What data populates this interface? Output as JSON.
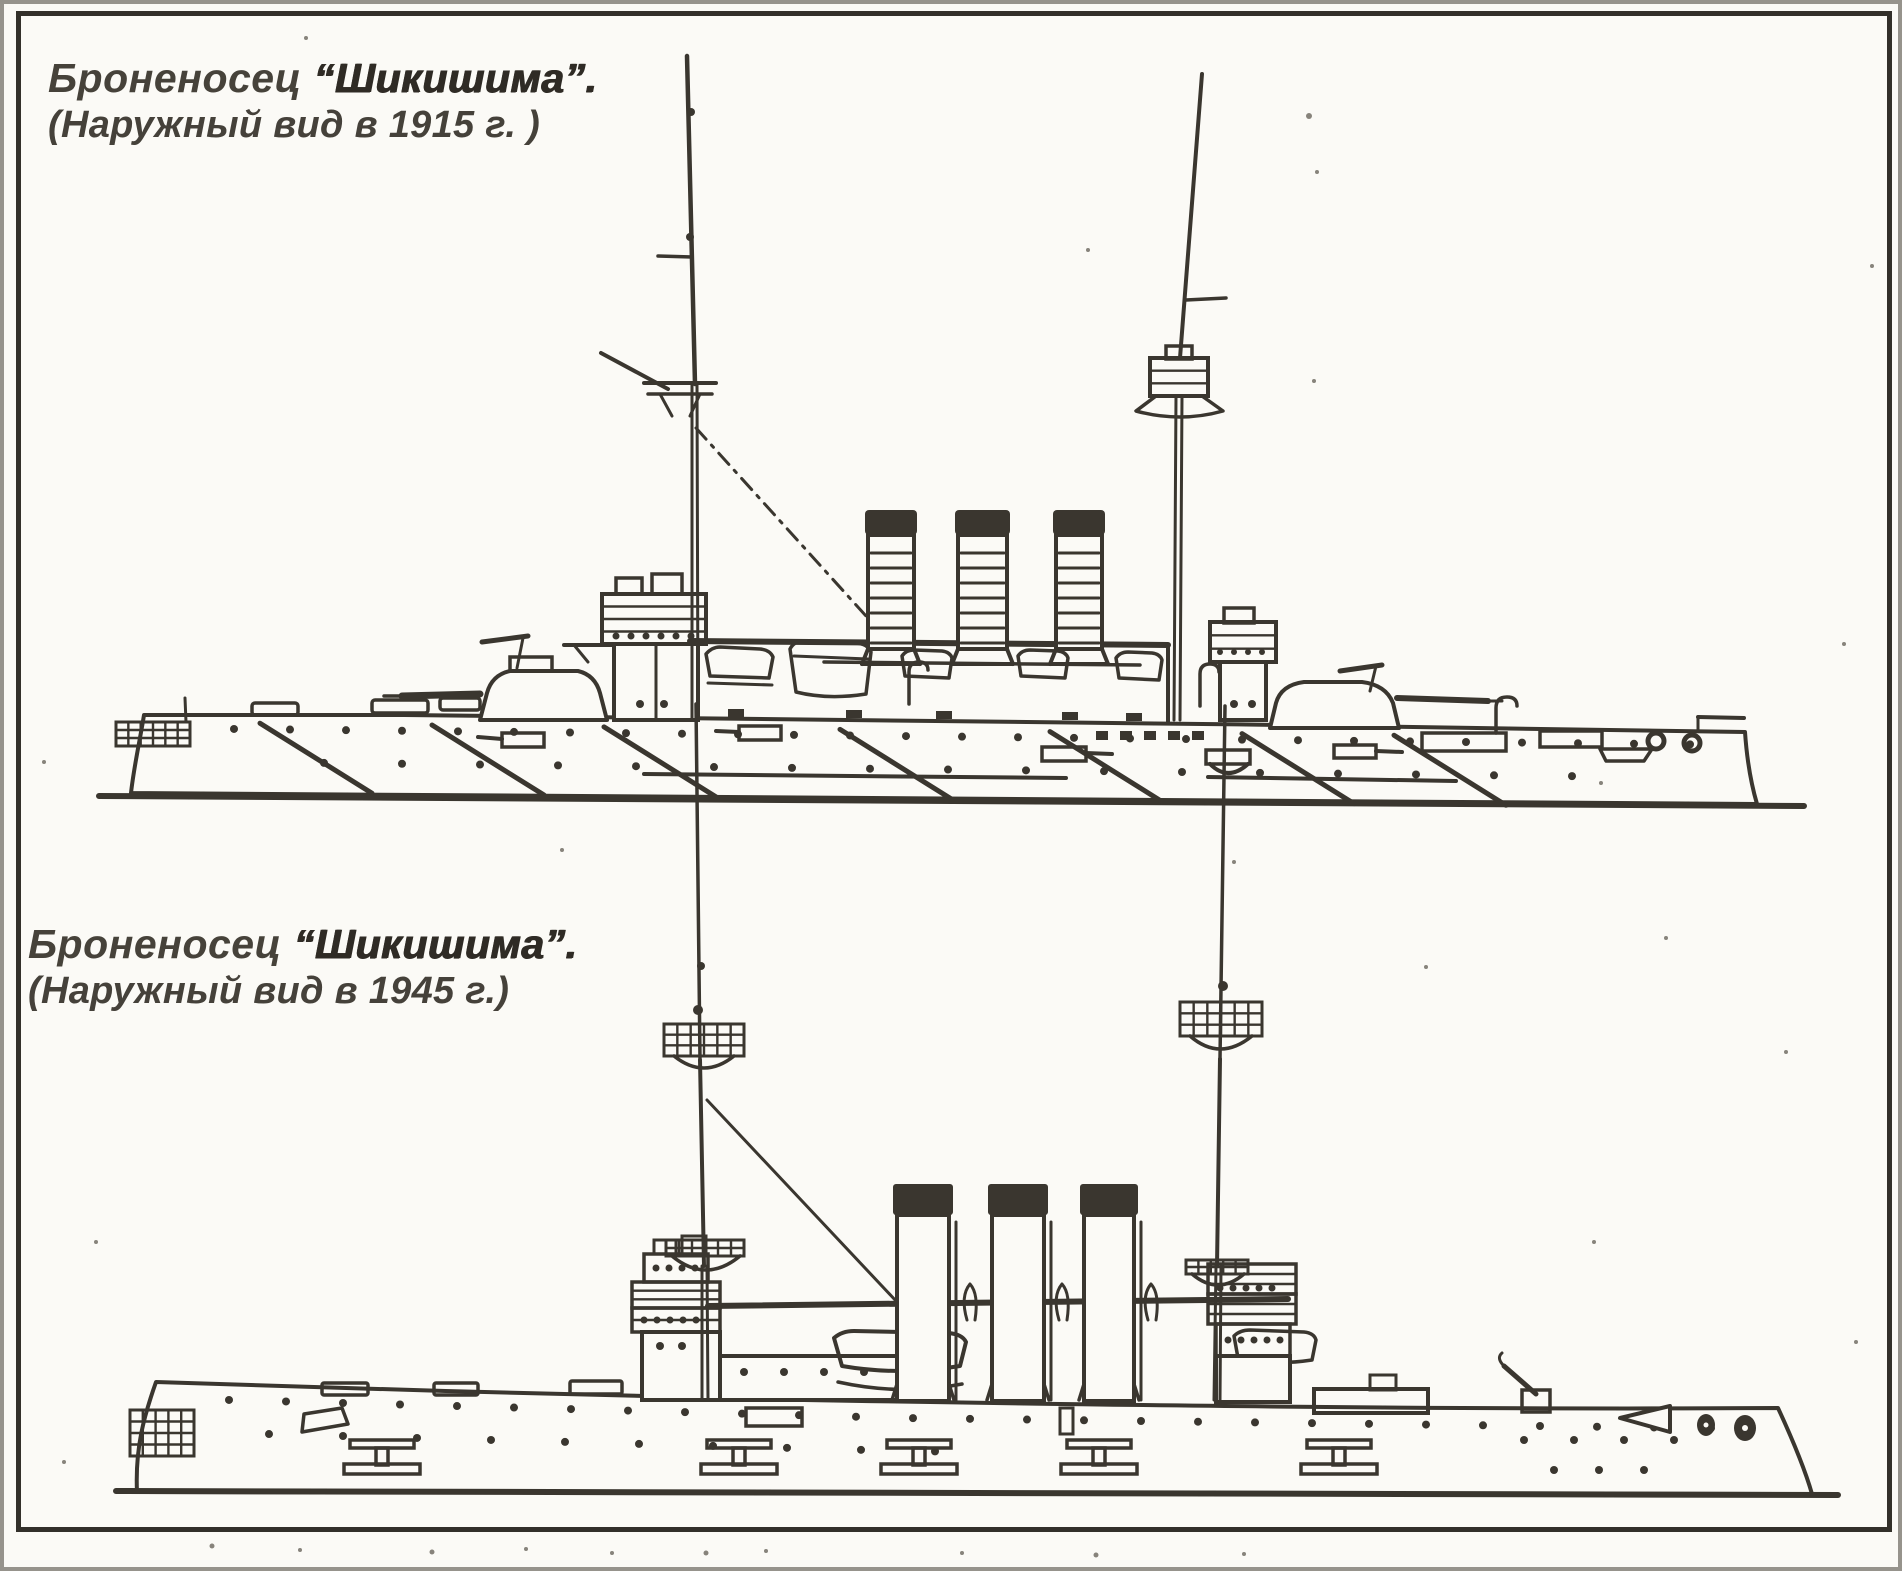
{
  "colors": {
    "ink": "#3a362f",
    "paper": "#fbfaf6",
    "frame": "#33302a",
    "speckle": "#87837b"
  },
  "figures": [
    {
      "caption": {
        "lead": "Броненосец",
        "name": "“Шикишима”.",
        "subtitle": "(Наружный вид в 1915 г. )"
      },
      "drawing": "battleship-side-profile-1915"
    },
    {
      "caption": {
        "lead": "Броненосец",
        "name": "“Шикишима”.",
        "subtitle": "(Наружный вид в 1945 г.)"
      },
      "drawing": "battleship-side-profile-1945"
    }
  ]
}
